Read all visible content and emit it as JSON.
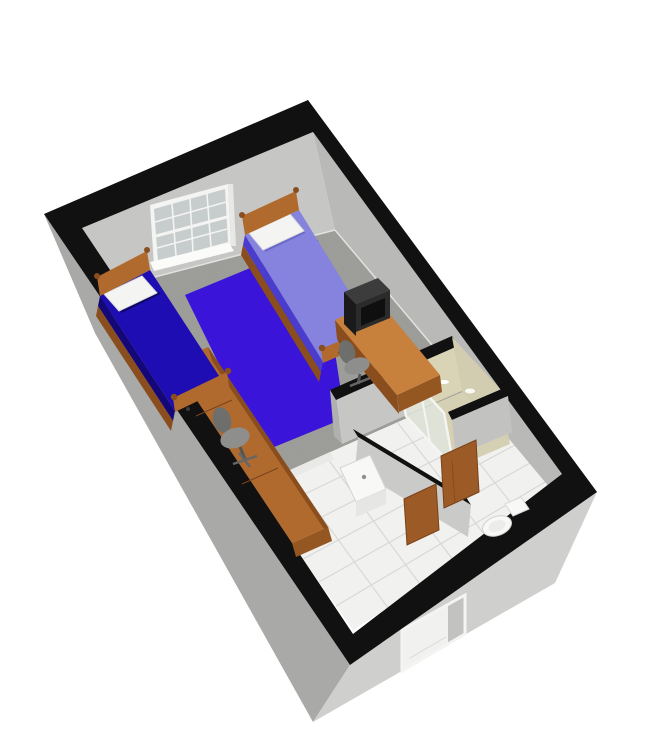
{
  "meta": {
    "title": "3D cutaway rendering of a dorm room floor plan",
    "view": "isometric dollhouse view, no visible text"
  },
  "colors": {
    "background": "#ffffff",
    "wall_top": "#111111",
    "wall_nw_face": "#c6c6c4",
    "wall_ne_face": "#b9b9b7",
    "ext_sw": "#a9a9a7",
    "ext_se": "#cfcfcd",
    "carpet": "#9a9a96",
    "tile": "#f1f1ef",
    "tile_line": "#d8d8d6",
    "threshold": "#e9e9e7",
    "rug": "#3a14d8",
    "bed_left_top": "#1d0db2",
    "bed_left_side": "#140878",
    "bed_right_top": "#8583de",
    "bed_right_side": "#4a3ccc",
    "pillow": "#f4f4f2",
    "wood": "#b06a2d",
    "wood_dark": "#8a4e1e",
    "wood_light": "#c8813c",
    "monitor_dark": "#1a1a1a",
    "monitor_mid": "#2b2b2b",
    "monitor_top": "#3c3c3c",
    "monitor_screen": "#0f0f0f",
    "chair": "#8e8e8c",
    "chair_dark": "#6e6e6c",
    "shower_wall": "#d9d4b6",
    "shower_wall2": "#d2cdb0",
    "shower_floor": "#d5d0b4",
    "glass": "#e2e9e4",
    "white_fixture": "#f8f8f6",
    "door": "#9c5a26",
    "door_dark": "#7a421a",
    "window_glass": "#c7cccd",
    "frame_white": "#f4f4f2",
    "reveal_gray": "#c2c2c0",
    "baseboard": "#e2e2e0"
  },
  "scene": {
    "rooms": [
      {
        "name": "bedroom",
        "floor": "gray carpet",
        "furniture": [
          "twin bed left with dark blue bedding and white pillow",
          "twin bed right with light periwinkle bedding and white pillow",
          "large blue area rug",
          "wooden desk with black CRT monitor and gray chair",
          "wooden dresser-desk run along left wall",
          "gray office chair",
          "grid-pane window in far wall"
        ]
      },
      {
        "name": "bathroom",
        "floor": "white tile",
        "fixtures": [
          "beige shower stall with white-framed glass door",
          "white vanity sink",
          "white toilet",
          "two open wooden doors"
        ]
      },
      {
        "name": "entry-hallway",
        "floor": "white tile",
        "features": [
          "exterior doorway opening in near wall"
        ]
      }
    ],
    "walls": "gray walls with thick black wall-top caps, cutaway dollhouse style"
  }
}
